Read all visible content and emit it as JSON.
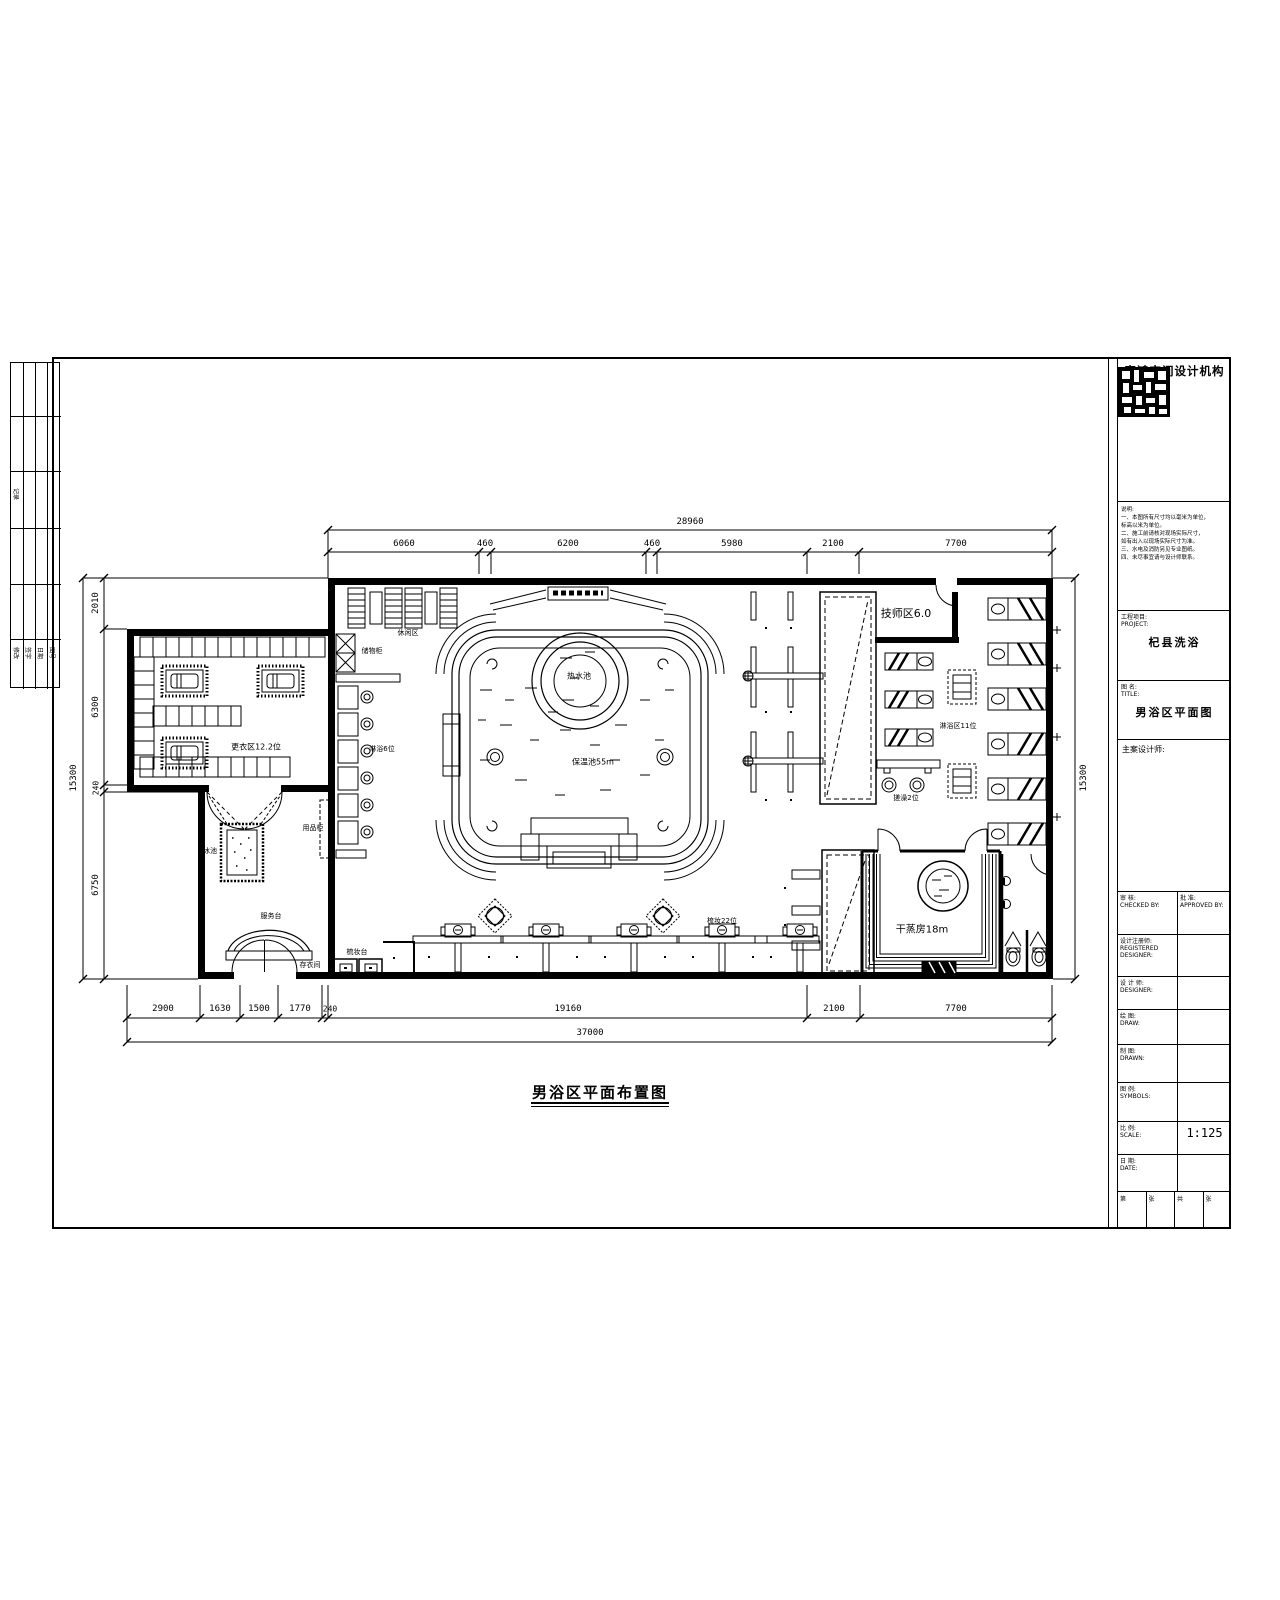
{
  "sheet": {
    "drawing_title": "男浴区平面布置图"
  },
  "title_block": {
    "company": "富鸿空间设计机构",
    "notes_heading": "说明:",
    "notes_lines": [
      "一、本图所有尺寸均以毫米为单位，",
      "标高以米为单位。",
      "二、施工前请核对现场实际尺寸，",
      "如有出入以现场实际尺寸为准。",
      "三、水电及消防另见专业图纸。",
      "四、未尽事宜请与设计师联系。"
    ],
    "project": {
      "cn": "工程项目:",
      "en": "PROJECT:",
      "value": "杞县洗浴"
    },
    "drawing": {
      "cn": "图 名:",
      "en": "TITLE:",
      "value": "男浴区平面图"
    },
    "designer_label": "主案设计师:",
    "rows": [
      {
        "cn": "审 核:",
        "en": "CHECKED BY:",
        "cn2": "批 准:",
        "en2": "APPROVED BY:"
      },
      {
        "cn": "设计注册师:",
        "en": "REGISTERED DESIGNER:"
      },
      {
        "cn": "设 计 师:",
        "en": "DESIGNER:"
      },
      {
        "cn": "绘 图:",
        "en": "DRAW:"
      },
      {
        "cn": "制 图:",
        "en": "DRAWN:"
      },
      {
        "cn": "图 例:",
        "en": "SYMBOLS:"
      },
      {
        "cn": "比 例:",
        "en": "SCALE:",
        "value": "1:125"
      },
      {
        "cn": "日 期:",
        "en": "DATE:"
      }
    ],
    "footer_cells": [
      "第",
      "张",
      "共",
      "张"
    ]
  },
  "revision_strip": {
    "labels": [
      "修改",
      "签字",
      "日期",
      "图号"
    ],
    "side_label": "记录"
  },
  "plan": {
    "labels": {
      "leisure": "休闲区",
      "locker_cabinet": "储物柜",
      "shower6": "淋浴6位",
      "changing": "更衣区12.2位",
      "supplies_cabinet": "用品柜",
      "ice_pool": "冰池",
      "service_desk": "服务台",
      "cloakroom": "存衣间",
      "vanity": "梳妆台",
      "hot_pool": "热水池",
      "warm_pool": "保温池55m",
      "tech_area": "技师区6.0",
      "scrub2": "搓澡2位",
      "shower11": "淋浴区11位",
      "vanity22": "梳妆22位",
      "steam_room": "干蒸房18m"
    }
  },
  "dims": {
    "top_total": "28960",
    "top": [
      "6060",
      "460",
      "6200",
      "460",
      "5980",
      "2100",
      "7700"
    ],
    "bottom": [
      "2900",
      "1630",
      "1500",
      "1770",
      "240",
      "19160",
      "2100",
      "7700"
    ],
    "bottom_total": "37000",
    "left": [
      "2010",
      "6300",
      "240",
      "6750"
    ],
    "left_total": "15300",
    "right_total": "15300"
  }
}
